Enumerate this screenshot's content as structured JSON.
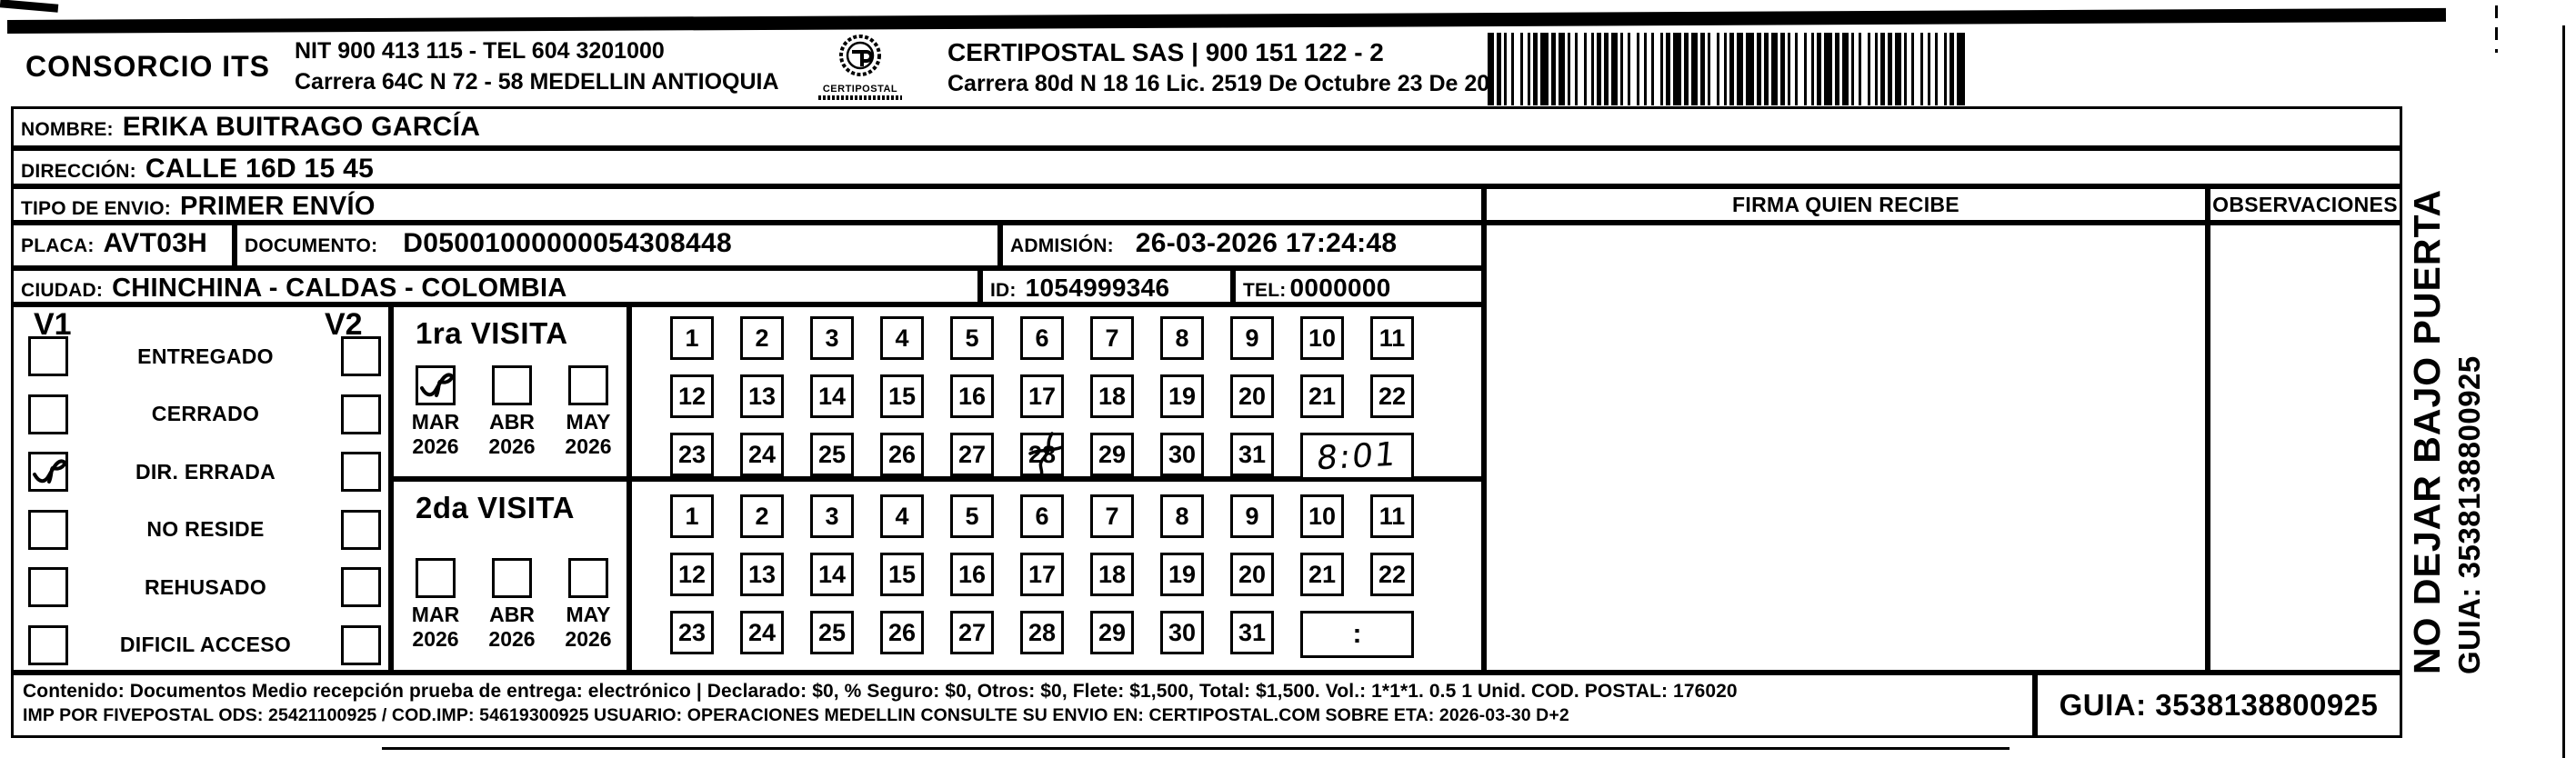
{
  "header": {
    "company_name": "CONSORCIO ITS",
    "company_nit_line": "NIT 900 413 115 - TEL 604 3201000",
    "company_address_line": "Carrera 64C N 72 - 58 MEDELLIN ANTIOQUIA",
    "logo_caption": "CERTIPOSTAL",
    "carrier_line": "CERTIPOSTAL SAS | 900 151 122 - 2",
    "carrier_address_line": "Carrera 80d N 18 16  Lic. 2519 De Octubre 23 De 2015"
  },
  "fields": {
    "nombre": {
      "label": "NOMBRE:",
      "value": "ERIKA BUITRAGO GARCÍA"
    },
    "direccion": {
      "label": "DIRECCIÓN:",
      "value": "CALLE 16D 15 45"
    },
    "tipo_envio": {
      "label": "TIPO DE ENVIO:",
      "value": "PRIMER ENVÍO"
    },
    "placa": {
      "label": "PLACA:",
      "value": "AVT03H"
    },
    "documento": {
      "label": "DOCUMENTO:",
      "value": "D05001000000054308448"
    },
    "admision": {
      "label": "ADMISIÓN:",
      "value": "26-03-2026 17:24:48"
    },
    "ciudad": {
      "label": "CIUDAD:",
      "value": "CHINCHINA - CALDAS - COLOMBIA"
    },
    "id": {
      "label": "ID:",
      "value": "1054999346"
    },
    "tel": {
      "label": "TEL:",
      "value": "0000000"
    }
  },
  "columns": {
    "firma_header": "FIRMA QUIEN RECIBE",
    "observaciones_header": "OBSERVACIONES"
  },
  "status_panel": {
    "v1_header": "V1",
    "v2_header": "V2",
    "options": [
      {
        "label": "ENTREGADO",
        "v1_checked": false,
        "v2_checked": false
      },
      {
        "label": "CERRADO",
        "v1_checked": false,
        "v2_checked": false
      },
      {
        "label": "DIR. ERRADA",
        "v1_checked": true,
        "v2_checked": false
      },
      {
        "label": "NO RESIDE",
        "v1_checked": false,
        "v2_checked": false
      },
      {
        "label": "REHUSADO",
        "v1_checked": false,
        "v2_checked": false
      },
      {
        "label": "DIFICIL ACCESO",
        "v1_checked": false,
        "v2_checked": false
      }
    ]
  },
  "day_numbers": [
    "1",
    "2",
    "3",
    "4",
    "5",
    "6",
    "7",
    "8",
    "9",
    "10",
    "11",
    "12",
    "13",
    "14",
    "15",
    "16",
    "17",
    "18",
    "19",
    "20",
    "21",
    "22",
    "23",
    "24",
    "25",
    "26",
    "27",
    "28",
    "29",
    "30",
    "31"
  ],
  "visits": [
    {
      "title": "1ra VISITA",
      "months": [
        {
          "month": "MAR",
          "year": "2026",
          "checked": true
        },
        {
          "month": "ABR",
          "year": "2026",
          "checked": false
        },
        {
          "month": "MAY",
          "year": "2026",
          "checked": false
        }
      ],
      "marked_day": "28",
      "time_value": "8:01",
      "time_handwritten": true
    },
    {
      "title": "2da VISITA",
      "months": [
        {
          "month": "MAR",
          "year": "2026",
          "checked": false
        },
        {
          "month": "ABR",
          "year": "2026",
          "checked": false
        },
        {
          "month": "MAY",
          "year": "2026",
          "checked": false
        }
      ],
      "marked_day": null,
      "time_value": ":",
      "time_handwritten": false
    }
  ],
  "side_note": {
    "line1": "NO DEJAR BAJO PUERTA",
    "line2": "GUIA: 3538138800925"
  },
  "footer": {
    "line1": "Contenido: Documentos Medio recepción prueba de entrega: electrónico | Declarado: $0, % Seguro: $0, Otros: $0, Flete: $1,500, Total: $1,500. Vol.: 1*1*1. 0.5  1 Unid. COD. POSTAL: 176020",
    "line2": "IMP POR FIVEPOSTAL ODS: 25421100925 / COD.IMP: 54619300925 USUARIO: OPERACIONES MEDELLIN CONSULTE SU ENVIO EN: CERTIPOSTAL.COM SOBRE ETA: 2026-03-30 D+2",
    "guia_label": "GUIA: 3538138800925"
  }
}
